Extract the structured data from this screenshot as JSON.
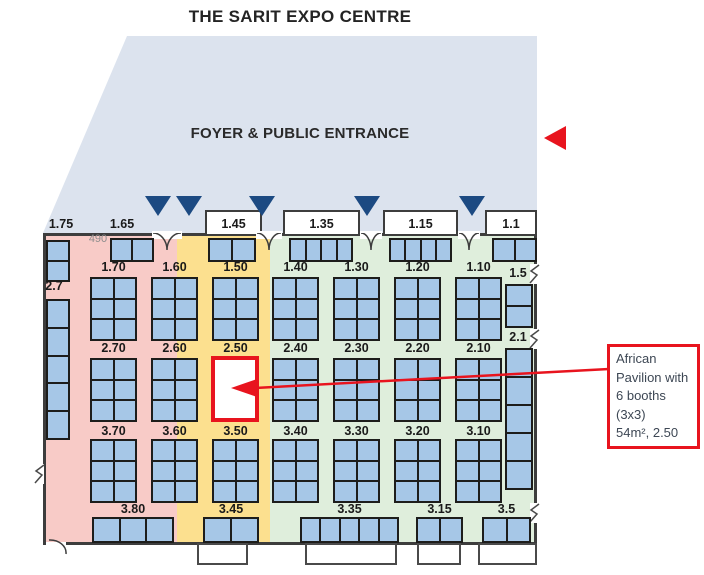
{
  "title": "THE SARIT EXPO CENTRE",
  "foyer": {
    "label": "FOYER & PUBLIC ENTRANCE"
  },
  "annotation": {
    "lines": [
      "African",
      "Pavilion with",
      "6 booths",
      "(3x3)",
      "54m², 2.50"
    ]
  },
  "colors": {
    "foyer_bg": "#dce3ee",
    "zone_pink": "#f8cbc7",
    "zone_yellow": "#fce08f",
    "zone_green": "#dfeedc",
    "booth_fill": "#a6c7e7",
    "booth_border": "#1d1d1b",
    "wall": "#3d3d3d",
    "entrance_triangle": "#1c4a82",
    "highlight_red": "#e8141e",
    "dim_text": "#8d8d8d",
    "label_text": "#1a1a1a",
    "annotation_text": "#3d4754"
  },
  "map": {
    "foyer_poly": "127,36 537,36 537,233 43,233",
    "hall": {
      "x": 43,
      "y": 233,
      "w": 494,
      "h": 312
    },
    "zones": [
      {
        "name": "pink",
        "x": 45,
        "y": 235,
        "w": 132,
        "h": 308
      },
      {
        "name": "yellow",
        "x": 177,
        "y": 235,
        "w": 93,
        "h": 308
      },
      {
        "name": "green",
        "x": 270,
        "y": 235,
        "w": 265,
        "h": 308
      }
    ],
    "top_bays": [
      {
        "x": 205,
        "w": 57
      },
      {
        "x": 283,
        "w": 77
      },
      {
        "x": 383,
        "w": 75
      },
      {
        "x": 485,
        "w": 52
      }
    ],
    "bottom_bays": [
      {
        "x": 197,
        "w": 51
      },
      {
        "x": 305,
        "w": 92
      },
      {
        "x": 417,
        "w": 44
      },
      {
        "x": 478,
        "w": 59
      }
    ],
    "doors": [
      {
        "x": 152,
        "w": 30
      },
      {
        "x": 256,
        "w": 26
      },
      {
        "x": 360,
        "w": 22
      },
      {
        "x": 458,
        "w": 22
      }
    ],
    "arc_door": {
      "x": 46,
      "y": 539
    },
    "wall_breaks": [
      {
        "x": 33,
        "y": 464
      },
      {
        "x": 528,
        "y": 264
      },
      {
        "x": 528,
        "y": 329
      },
      {
        "x": 528,
        "y": 503
      }
    ],
    "entrance_triangles": [
      158,
      189,
      262,
      367,
      472
    ],
    "blocks": [
      [
        110,
        238,
        44,
        24,
        2,
        1
      ],
      [
        208,
        238,
        48,
        24,
        2,
        1
      ],
      [
        289,
        238,
        64,
        24,
        4,
        1
      ],
      [
        389,
        238,
        63,
        24,
        4,
        1
      ],
      [
        492,
        238,
        45,
        24,
        2,
        1
      ],
      [
        46,
        240,
        24,
        42,
        1,
        2
      ],
      [
        46,
        299,
        24,
        141,
        1,
        5
      ],
      [
        505,
        284,
        28,
        44,
        1,
        2
      ],
      [
        505,
        348,
        28,
        142,
        1,
        5
      ],
      [
        90,
        277,
        47,
        64,
        2,
        3
      ],
      [
        151,
        277,
        47,
        64,
        2,
        3
      ],
      [
        212,
        277,
        47,
        64,
        2,
        3
      ],
      [
        272,
        277,
        47,
        64,
        2,
        3
      ],
      [
        333,
        277,
        47,
        64,
        2,
        3
      ],
      [
        394,
        277,
        47,
        64,
        2,
        3
      ],
      [
        455,
        277,
        47,
        64,
        2,
        3
      ],
      [
        90,
        358,
        47,
        64,
        2,
        3
      ],
      [
        151,
        358,
        47,
        64,
        2,
        3
      ],
      [
        272,
        358,
        47,
        64,
        2,
        3
      ],
      [
        333,
        358,
        47,
        64,
        2,
        3
      ],
      [
        394,
        358,
        47,
        64,
        2,
        3
      ],
      [
        455,
        358,
        47,
        64,
        2,
        3
      ],
      [
        90,
        439,
        47,
        64,
        2,
        3
      ],
      [
        151,
        439,
        47,
        64,
        2,
        3
      ],
      [
        212,
        439,
        47,
        64,
        2,
        3
      ],
      [
        272,
        439,
        47,
        64,
        2,
        3
      ],
      [
        333,
        439,
        47,
        64,
        2,
        3
      ],
      [
        394,
        439,
        47,
        64,
        2,
        3
      ],
      [
        455,
        439,
        47,
        64,
        2,
        3
      ],
      [
        92,
        517,
        82,
        26,
        3,
        1
      ],
      [
        203,
        517,
        56,
        26,
        2,
        1
      ],
      [
        300,
        517,
        99,
        26,
        5,
        1
      ],
      [
        416,
        517,
        47,
        26,
        2,
        1
      ],
      [
        482,
        517,
        49,
        26,
        2,
        1
      ]
    ],
    "labels": [
      [
        "1.75",
        40,
        217,
        42
      ],
      [
        "1.65",
        101,
        217,
        42
      ],
      [
        "1.45",
        205,
        217,
        57
      ],
      [
        "1.35",
        283,
        217,
        77
      ],
      [
        "1.15",
        383,
        217,
        75
      ],
      [
        "1.1",
        485,
        217,
        52
      ],
      [
        "490",
        80,
        232,
        36,
        "dim"
      ],
      [
        "2.7",
        38,
        279,
        32
      ],
      [
        "1.5",
        501,
        266,
        34
      ],
      [
        "2.1",
        501,
        330,
        34
      ],
      [
        "1.70",
        90,
        260,
        47
      ],
      [
        "1.60",
        151,
        260,
        47
      ],
      [
        "1.50",
        212,
        260,
        47
      ],
      [
        "1.40",
        272,
        260,
        47
      ],
      [
        "1.30",
        333,
        260,
        47
      ],
      [
        "1.20",
        394,
        260,
        47
      ],
      [
        "1.10",
        455,
        260,
        47
      ],
      [
        "2.70",
        90,
        341,
        47
      ],
      [
        "2.60",
        151,
        341,
        47
      ],
      [
        "2.50",
        212,
        341,
        47
      ],
      [
        "2.40",
        272,
        341,
        47
      ],
      [
        "2.30",
        333,
        341,
        47
      ],
      [
        "2.20",
        394,
        341,
        47
      ],
      [
        "2.10",
        455,
        341,
        47
      ],
      [
        "3.70",
        90,
        424,
        47
      ],
      [
        "3.60",
        151,
        424,
        47
      ],
      [
        "3.50",
        212,
        424,
        47
      ],
      [
        "3.40",
        272,
        424,
        47
      ],
      [
        "3.30",
        333,
        424,
        47
      ],
      [
        "3.20",
        394,
        424,
        47
      ],
      [
        "3.10",
        455,
        424,
        47
      ],
      [
        "3.80",
        92,
        502,
        82
      ],
      [
        "3.45",
        203,
        502,
        56
      ],
      [
        "3.35",
        300,
        502,
        99
      ],
      [
        "3.15",
        416,
        502,
        47
      ],
      [
        "3.5",
        482,
        502,
        49
      ]
    ],
    "highlight": {
      "x": 211,
      "y": 356,
      "w": 48,
      "h": 66
    },
    "arrow": {
      "x1": 609,
      "y1": 369,
      "x2": 255,
      "y2": 388,
      "head": "231,388 257,379 257,397"
    }
  }
}
